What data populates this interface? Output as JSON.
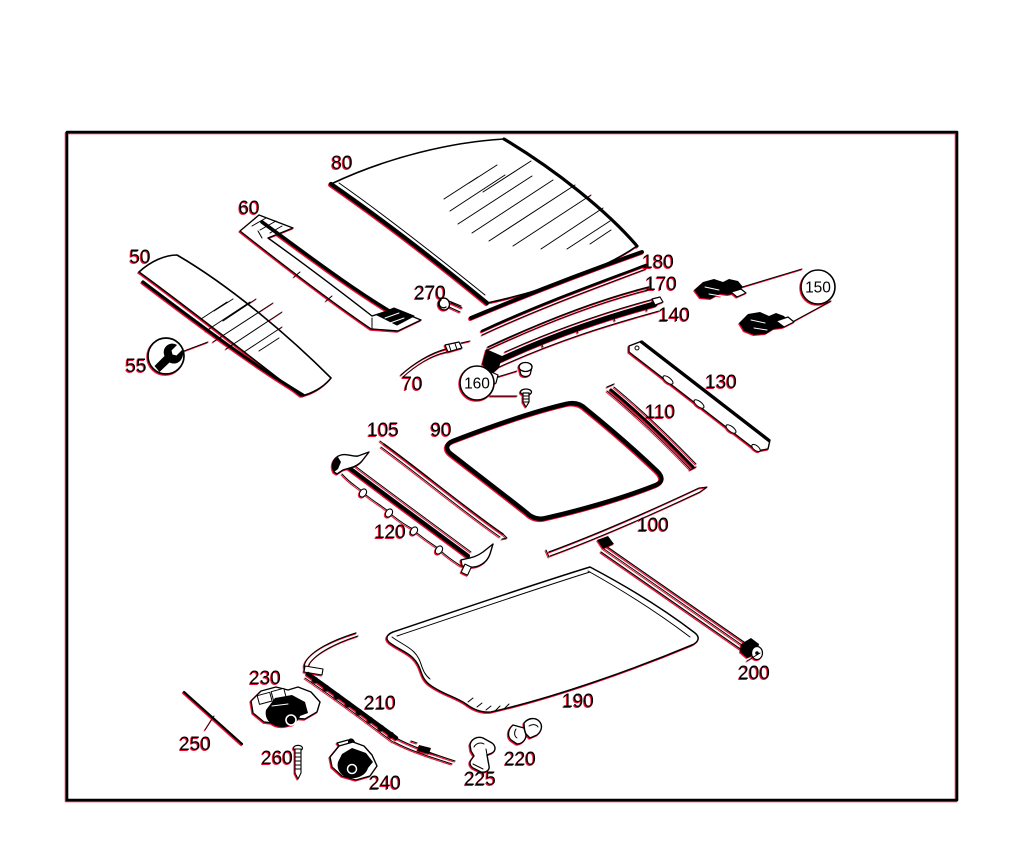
{
  "page": {
    "background": "#ffffff"
  },
  "frame": {
    "x": 67,
    "y": 132,
    "width": 890,
    "height": 668,
    "border_color": "#000000"
  },
  "diagram": {
    "type": "exploded-parts-diagram",
    "line_color": "#000000",
    "fringe_color": "#e8112d",
    "symbols": [
      {
        "name": "wrench-icon",
        "cx": 166,
        "cy": 356,
        "r": 18,
        "linked_callout": "55"
      }
    ],
    "callouts": [
      {
        "label": "50",
        "x": 140,
        "y": 256,
        "circled": false
      },
      {
        "label": "55",
        "x": 136,
        "y": 365,
        "circled": false
      },
      {
        "label": "60",
        "x": 249,
        "y": 207,
        "circled": false
      },
      {
        "label": "70",
        "x": 412,
        "y": 383,
        "circled": false
      },
      {
        "label": "80",
        "x": 342,
        "y": 162,
        "circled": false
      },
      {
        "label": "90",
        "x": 441,
        "y": 429,
        "circled": false
      },
      {
        "label": "100",
        "x": 653,
        "y": 524,
        "circled": false
      },
      {
        "label": "105",
        "x": 383,
        "y": 429,
        "circled": false
      },
      {
        "label": "110",
        "x": 660,
        "y": 411,
        "circled": false
      },
      {
        "label": "120",
        "x": 390,
        "y": 531,
        "circled": false
      },
      {
        "label": "130",
        "x": 721,
        "y": 381,
        "circled": false
      },
      {
        "label": "140",
        "x": 674,
        "y": 314,
        "circled": false
      },
      {
        "label": "150",
        "x": 818,
        "y": 287,
        "circled": true,
        "r": 17
      },
      {
        "label": "160",
        "x": 477,
        "y": 383,
        "circled": true,
        "r": 17
      },
      {
        "label": "170",
        "x": 661,
        "y": 283,
        "circled": false
      },
      {
        "label": "180",
        "x": 658,
        "y": 261,
        "circled": false
      },
      {
        "label": "190",
        "x": 578,
        "y": 700,
        "circled": false
      },
      {
        "label": "200",
        "x": 754,
        "y": 672,
        "circled": false
      },
      {
        "label": "210",
        "x": 380,
        "y": 702,
        "circled": false
      },
      {
        "label": "220",
        "x": 520,
        "y": 758,
        "circled": false
      },
      {
        "label": "225",
        "x": 480,
        "y": 778,
        "circled": false
      },
      {
        "label": "230",
        "x": 265,
        "y": 677,
        "circled": false
      },
      {
        "label": "240",
        "x": 385,
        "y": 782,
        "circled": false
      },
      {
        "label": "250",
        "x": 195,
        "y": 743,
        "circled": false
      },
      {
        "label": "260",
        "x": 277,
        "y": 757,
        "circled": false
      },
      {
        "label": "270",
        "x": 430,
        "y": 292,
        "circled": false
      }
    ]
  }
}
